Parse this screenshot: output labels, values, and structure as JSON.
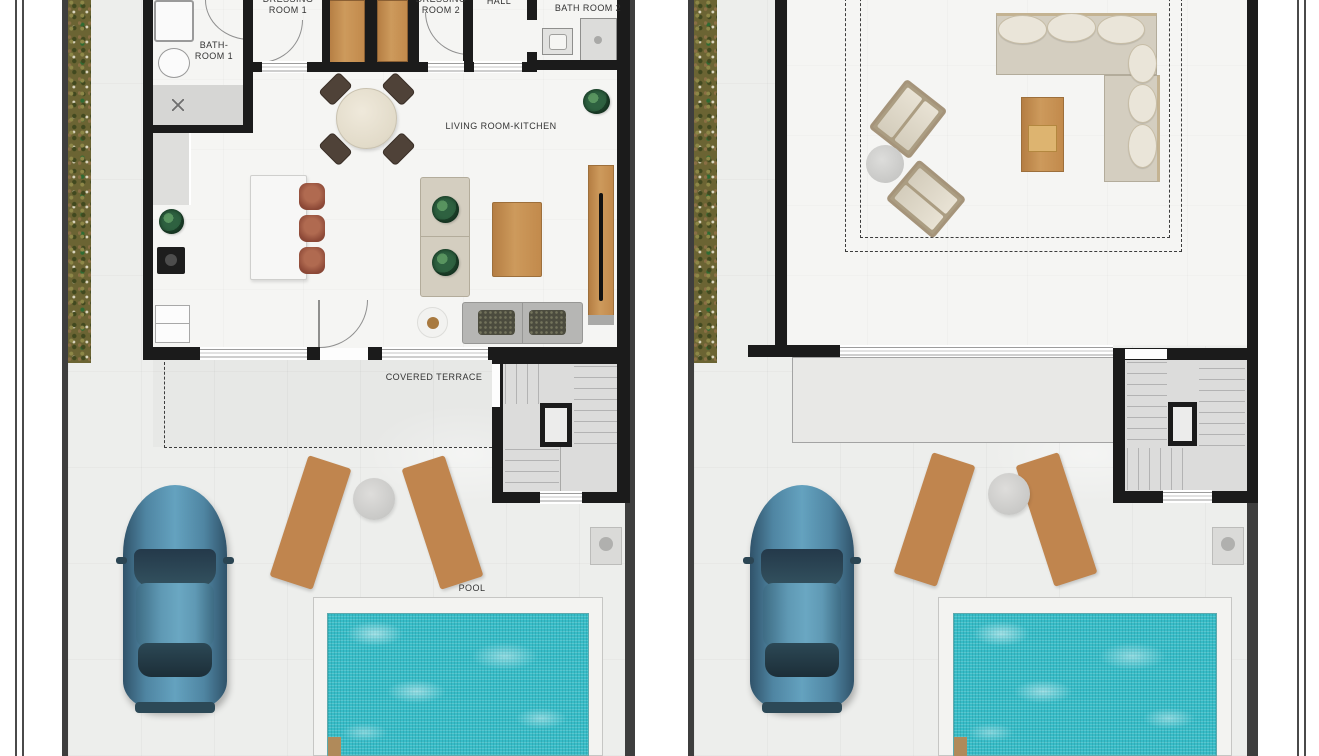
{
  "sheet": {
    "description": "Two top-view villa floor plans side by side: ground floor with living room-kitchen, bathrooms, dressing rooms, covered terrace, pool and parked car (left); roof solarium terrace with lounge furniture, stairs, pool and parked car (right)"
  },
  "left_plan": {
    "labels": {
      "bathroom1": [
        "BATH-",
        "ROOM 1"
      ],
      "dressing1": [
        "DRESSING",
        "ROOM 1"
      ],
      "dressing2": [
        "DRESSING",
        "ROOM 2"
      ],
      "hall": "HALL",
      "bathroom2": "BATH ROOM 2",
      "living": "LIVING ROOM-KITCHEN",
      "terrace": "COVERED TERRACE",
      "pool": "POOL"
    }
  },
  "right_plan": {
    "labels": {}
  },
  "colors": {
    "wall": "#1b1b1b",
    "plot_border": "#3e3e3e",
    "paving": "#edeeec",
    "house_floor": "#f5f5f3",
    "stair_floor": "#dcdcdb",
    "pool_water": "#37bcc7",
    "pool_deck": "#f3f3f1",
    "vegetation": "#6b6433",
    "wood_furniture": "#c08b50",
    "sofa_beige": "#d4cec0",
    "car_blue": "#4f85a2"
  }
}
